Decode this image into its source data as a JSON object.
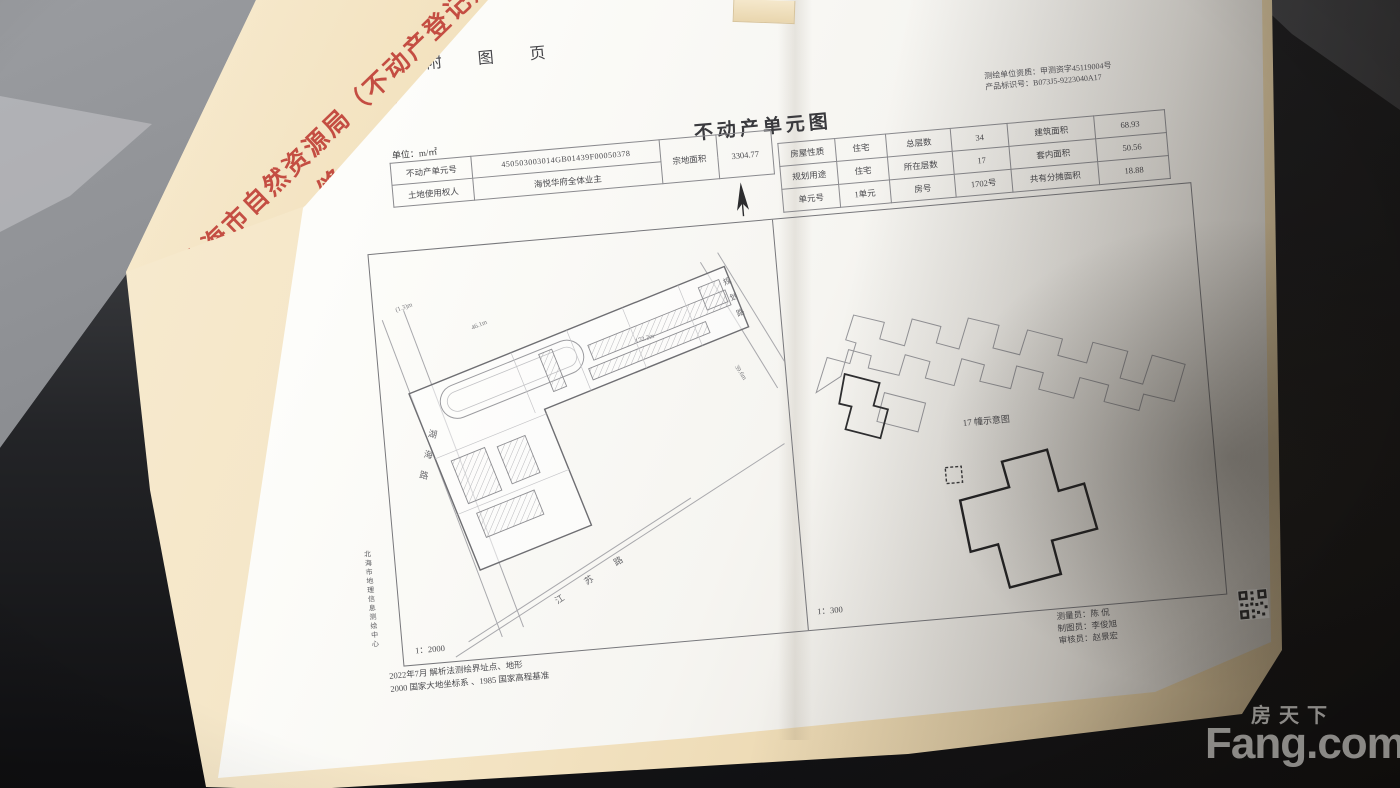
{
  "colors": {
    "stamp_red": "#ba2c26",
    "paper": "#fbfaf7",
    "cover_beige": "#f3e3c2"
  },
  "watermark": {
    "cn": "房天下",
    "en": "Fang.com"
  },
  "stamp": {
    "line1": "北海市自然资源局（不动产登记）",
    "line2": "骑 缝 章"
  },
  "page": {
    "header": "附 图 页",
    "title": "不动产单元图",
    "cert": {
      "qualification": "测绘单位资质：甲测资字45119004号",
      "product_id": "产品标识号：B073J5-9223040A17"
    },
    "form_left": {
      "unit_label": "单位：m/㎡",
      "row1_label": "不动产单元号",
      "unit_number": "450503003014GB01439F00050378",
      "row2_label": "土地使用权人",
      "owner": "海悦华府全体业主",
      "area_label": "宗地面积",
      "area_value": "3304.77"
    },
    "form_right": {
      "rows": [
        {
          "c1": "房屋性质",
          "c2": "住宅",
          "c3": "总层数",
          "c4": "34",
          "c5": "建筑面积",
          "c6": "68.93"
        },
        {
          "c1": "规划用途",
          "c2": "住宅",
          "c3": "所在层数",
          "c4": "17",
          "c5": "套内面积",
          "c6": "50.56"
        },
        {
          "c1": "单元号",
          "c2": "1单元",
          "c3": "房号",
          "c4": "1702号",
          "c5": "共有分摊面积",
          "c6": "18.88"
        }
      ]
    },
    "site_plan": {
      "scale": "1：2000",
      "road_left": "湖海路",
      "road_bottom": "江苏路",
      "road_right": "规划路",
      "dim_top": "46.1m",
      "dim_mid": "172.2m",
      "dim_right": "39.6m",
      "dim_small": "(1.3)m"
    },
    "unit_plan": {
      "caption": "17 幢示意图",
      "scale": "1：300"
    },
    "footer": {
      "line1": "2022年7月 解析法测绘界址点、地形",
      "line2": "2000 国家大地坐标系 、1985 国家高程基准",
      "agency": "北海市地理信息测绘中心",
      "surveyor": "测量员：陈 侃",
      "drafter": "制图员：李俊旭",
      "reviewer": "审核员：赵景宏"
    }
  }
}
